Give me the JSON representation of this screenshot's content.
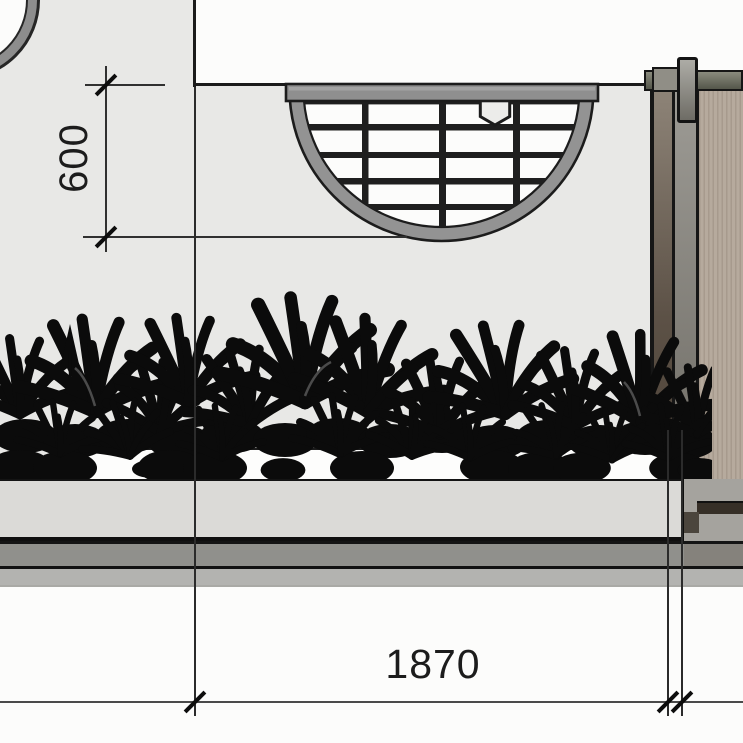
{
  "drawing": {
    "type": "architectural landscape plan detail",
    "dimension_labels": {
      "vertical": "600",
      "horizontal": "1870"
    },
    "elements": {
      "corner_circle": "partial circular feature at top-left corner",
      "wall_outline": "L-shaped wall edge",
      "round_grate": "semicircular slatted grate with hexagonal knob",
      "hex_knob": "hexagon marker inside grate",
      "planting_bed": "dense shrub / foliage silhouettes",
      "planter_wall": "raised planter front wall",
      "paving_bands": "paving edge bands below planter",
      "door_frame": "framed tan screen door panel at right",
      "door_hinge_post": "hinge post at top of door frame"
    },
    "colors": {
      "paving_background": "#e8e8e6",
      "outline": "#1a1a1a",
      "ring_gray": "#939393",
      "slat_black": "#1f1f1f",
      "planting_black": "#0b0b0b",
      "planter_wall_gray": "#dbdad7",
      "band_dark": "#90908c",
      "band_light": "#b3b3b0",
      "door_panel_tan": "#b6aa9d",
      "door_bar_olive": "#54564a"
    }
  }
}
